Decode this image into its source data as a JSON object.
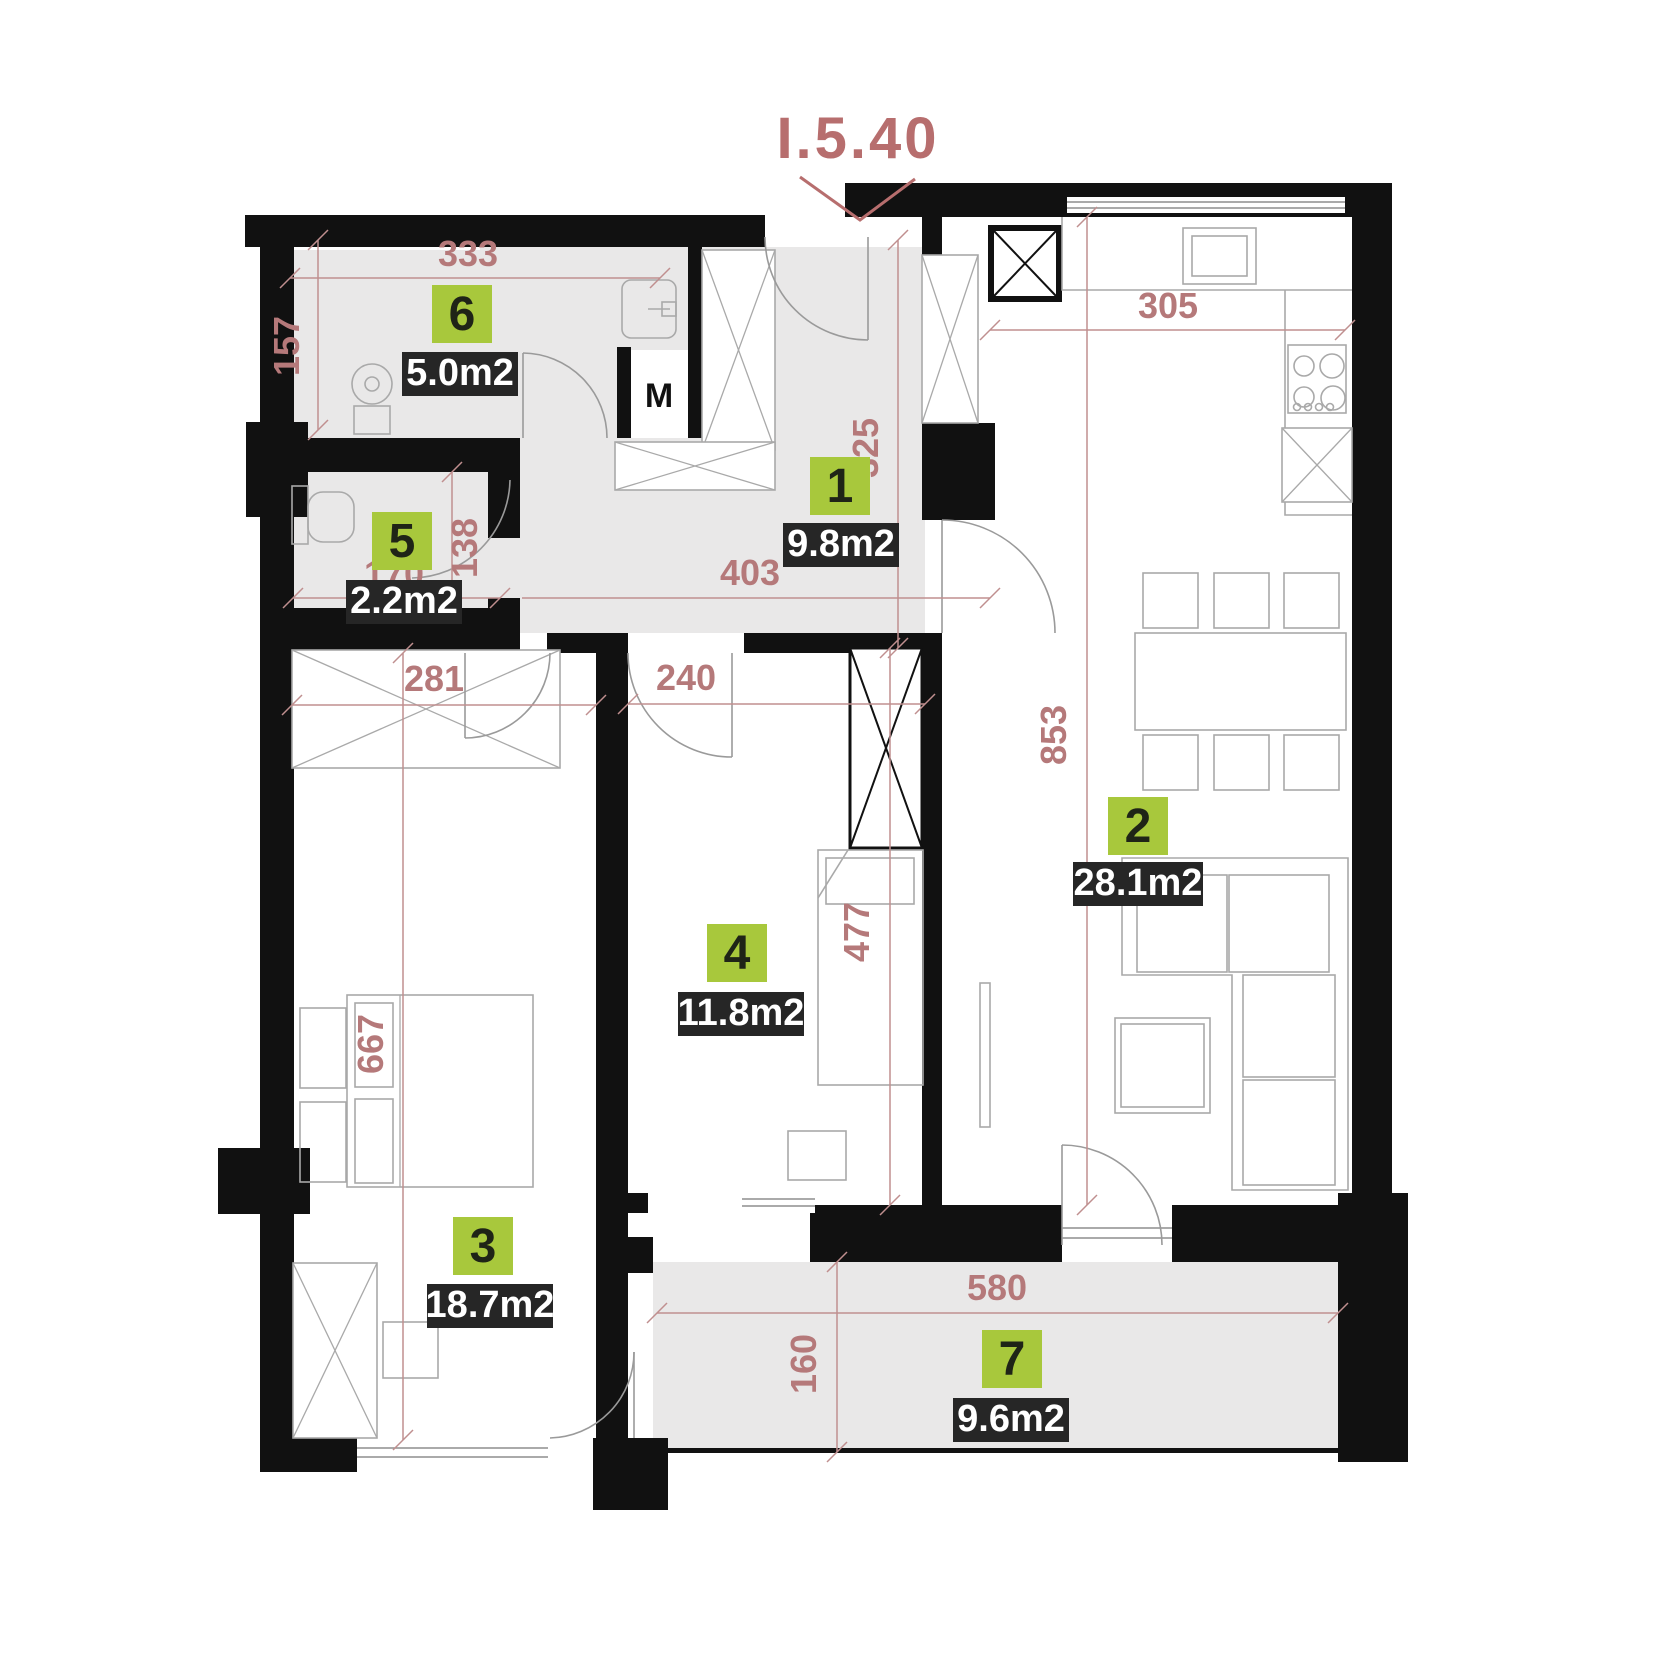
{
  "title": "I.5.40",
  "utility_room_label": "M",
  "rooms": [
    {
      "number": "1",
      "area": "9.8m2"
    },
    {
      "number": "2",
      "area": "28.1m2"
    },
    {
      "number": "3",
      "area": "18.7m2"
    },
    {
      "number": "4",
      "area": "11.8m2"
    },
    {
      "number": "5",
      "area": "2.2m2"
    },
    {
      "number": "6",
      "area": "5.0m2"
    },
    {
      "number": "7",
      "area": "9.6m2"
    }
  ],
  "dimensions_cm": {
    "d333": "333",
    "d157": "157",
    "d305": "305",
    "d325": "325",
    "d403": "403",
    "d138": "138",
    "d170": "170",
    "d281": "281",
    "d240": "240",
    "d853": "853",
    "d477": "477",
    "d667": "667",
    "d580": "580",
    "d160": "160"
  },
  "colors": {
    "accent_green": "#a8c83c",
    "label_background": "#262626",
    "label_text": "#ffffff",
    "dimension_color": "#b5797a",
    "title_color": "#b76e6e",
    "wall_color": "#111111",
    "floor_gray": "#e9e8e8"
  }
}
